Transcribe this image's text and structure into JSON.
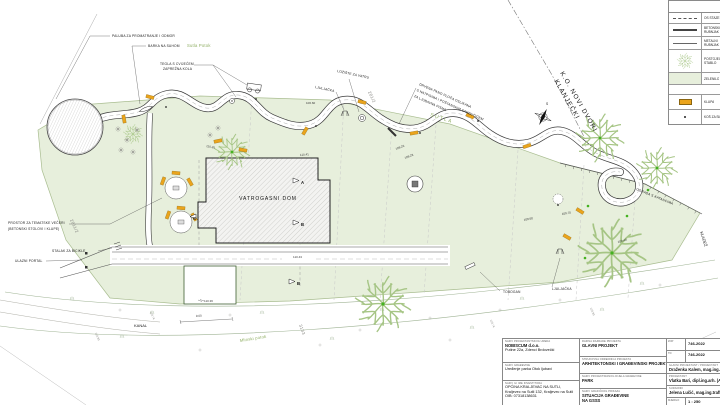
{
  "legend": {
    "title": "LEGENDA",
    "items": [
      {
        "label1": "OS STAZE",
        "label2": ""
      },
      {
        "label1": "BETONSKI",
        "label2": "RUBNJAK"
      },
      {
        "label1": "METALNI",
        "label2": "RUBNJAK"
      },
      {
        "label1": "POSTOJEĆE",
        "label2": "STABLO"
      },
      {
        "label1": "ZELENILO",
        "label2": ""
      }
    ],
    "section2": "OPREMA",
    "items2": [
      {
        "label1": "KLUPA"
      },
      {
        "label1": "KOŠ ZA SMEĆE"
      }
    ]
  },
  "titleblock": {
    "col1": {
      "r1_label": "NAZIV PROJEKTANTSKOG UREDA",
      "r1_line1": "NOBISCUM d.o.o.",
      "r1_line2": "Putine 22a, Zdenci Brdovečki",
      "r2_label": "NAZIV GRAĐEVINE",
      "r2_line1": "Uređenje parka Otok ljubavi",
      "r3_label": "NAZIV ILI IME INVESTITORA",
      "r3_line1": "OPĆINA KRALJEVAC NA SUTLI,",
      "r3_line2": "Kraljevec na Sutli 132, Kraljevec na Sutli",
      "r3_line3": "OIB: 07318138631"
    },
    "col2": {
      "r1_label": "RAZINA RAZRADE PROJEKTA",
      "r1_value": "GLAVNI PROJEKT",
      "r2_label": "STRUKOVNA ODREDNICA PROJEKTA",
      "r2_value": "ARHITEKTONSKI I GRAĐEVINSKI PROJEKT",
      "r3_label": "NAZIV PROJEKTIRANOG DIJELA GRAĐEVINE",
      "r3_value": "PARK",
      "r4_label": "NAZIV GRAFIČKOG PRIKAZA",
      "r4_line1": "SITUACIJA GRAĐEVINE",
      "r4_line2": "NA GSSS"
    },
    "col3": {
      "r1_label": "ZOP",
      "r1_value": "746-2022",
      "r1_extra": "DATUM",
      "r2_label": "TD",
      "r2_value": "746-2022",
      "r2_extra": "BROJ",
      "r3_label": "GLAVNI PROJEKTANT / PROJEKTANT",
      "r3_value": "Draženka Kalem, mag.ing.arh.",
      "r4_label": "PROJEKTANT",
      "r4_value": "Vlatka Bari, dipl.ing.arh. (A",
      "r5_label": "SURADNIK",
      "r5_value": "Jelena Lučić, mag.ing.traff.",
      "r6_label": "MJERILO",
      "r6_value": "1 : 250",
      "r6_extra": "LIST"
    }
  },
  "labels": {
    "paluba": "PALUBA ZA PROMATRANJE I ODMOR",
    "barka": "BARKA NA SUHOM",
    "sutla_potok": "Sutla Potok",
    "tegla": "TEGLA S CVIJEĆEM",
    "zaprezna": "ZAPREŽNA KOLA",
    "loziste": "LOŽIŠTE ZA VATRU",
    "ljuljacka_top": "LJULJAČKA",
    "pano_1": "DRVENA PANO PLOČA OSLIKANA",
    "pano_2": "S NATPISIMA I POŠTANSKIM SANDUČIĆEM",
    "pano_3": "ZA LJUBAVNA PISMA",
    "sutla": "SUTLA",
    "ko_line1": "K.O. NOVI DVORI",
    "ko_line2": "KLANJEČKI",
    "compass": "S",
    "vatrogasni_dom": "VATROGASNI DOM",
    "prostor_1": "PROSTOR ZA TEMATSKE VEČERI",
    "prostor_2": "(BETONSKI STOLOVI I KLUPE)",
    "stalak": "STALAK ZA BICIKLE",
    "ulazni_portal": "ULAZNI PORTAL",
    "tobogan": "TOBOGAN",
    "ljuljacka_bottom": "LJULJAČKA",
    "ograda": "OGRADA S KATANCIMA",
    "kladez": "KLADEŽ",
    "kanal": "KANAL",
    "mlinski_potok": "Mlinski potok",
    "marker_a": "A",
    "marker_b": "B",
    "marker_c": "C"
  },
  "parcels": {
    "top": "281/2",
    "left": "2811/2",
    "bottom": "3133"
  },
  "elevations": {
    "e1": "106.60",
    "e2": "110.30",
    "e3": "110.41",
    "e4": "108.26",
    "e5": "108.28",
    "e6": "109.60",
    "e7": "109.70",
    "e8": "109.40",
    "e9": "110.43",
    "e10": "110.36",
    "e11": "9.00",
    "e12": "110.74",
    "e13": "110.90"
  },
  "colors": {
    "park_green": "#e7efdc",
    "tree_green": "#a6c585",
    "accent_green": "#44b220",
    "bench_orange": "#eaa41c",
    "water_text_green": "#8fae63"
  }
}
